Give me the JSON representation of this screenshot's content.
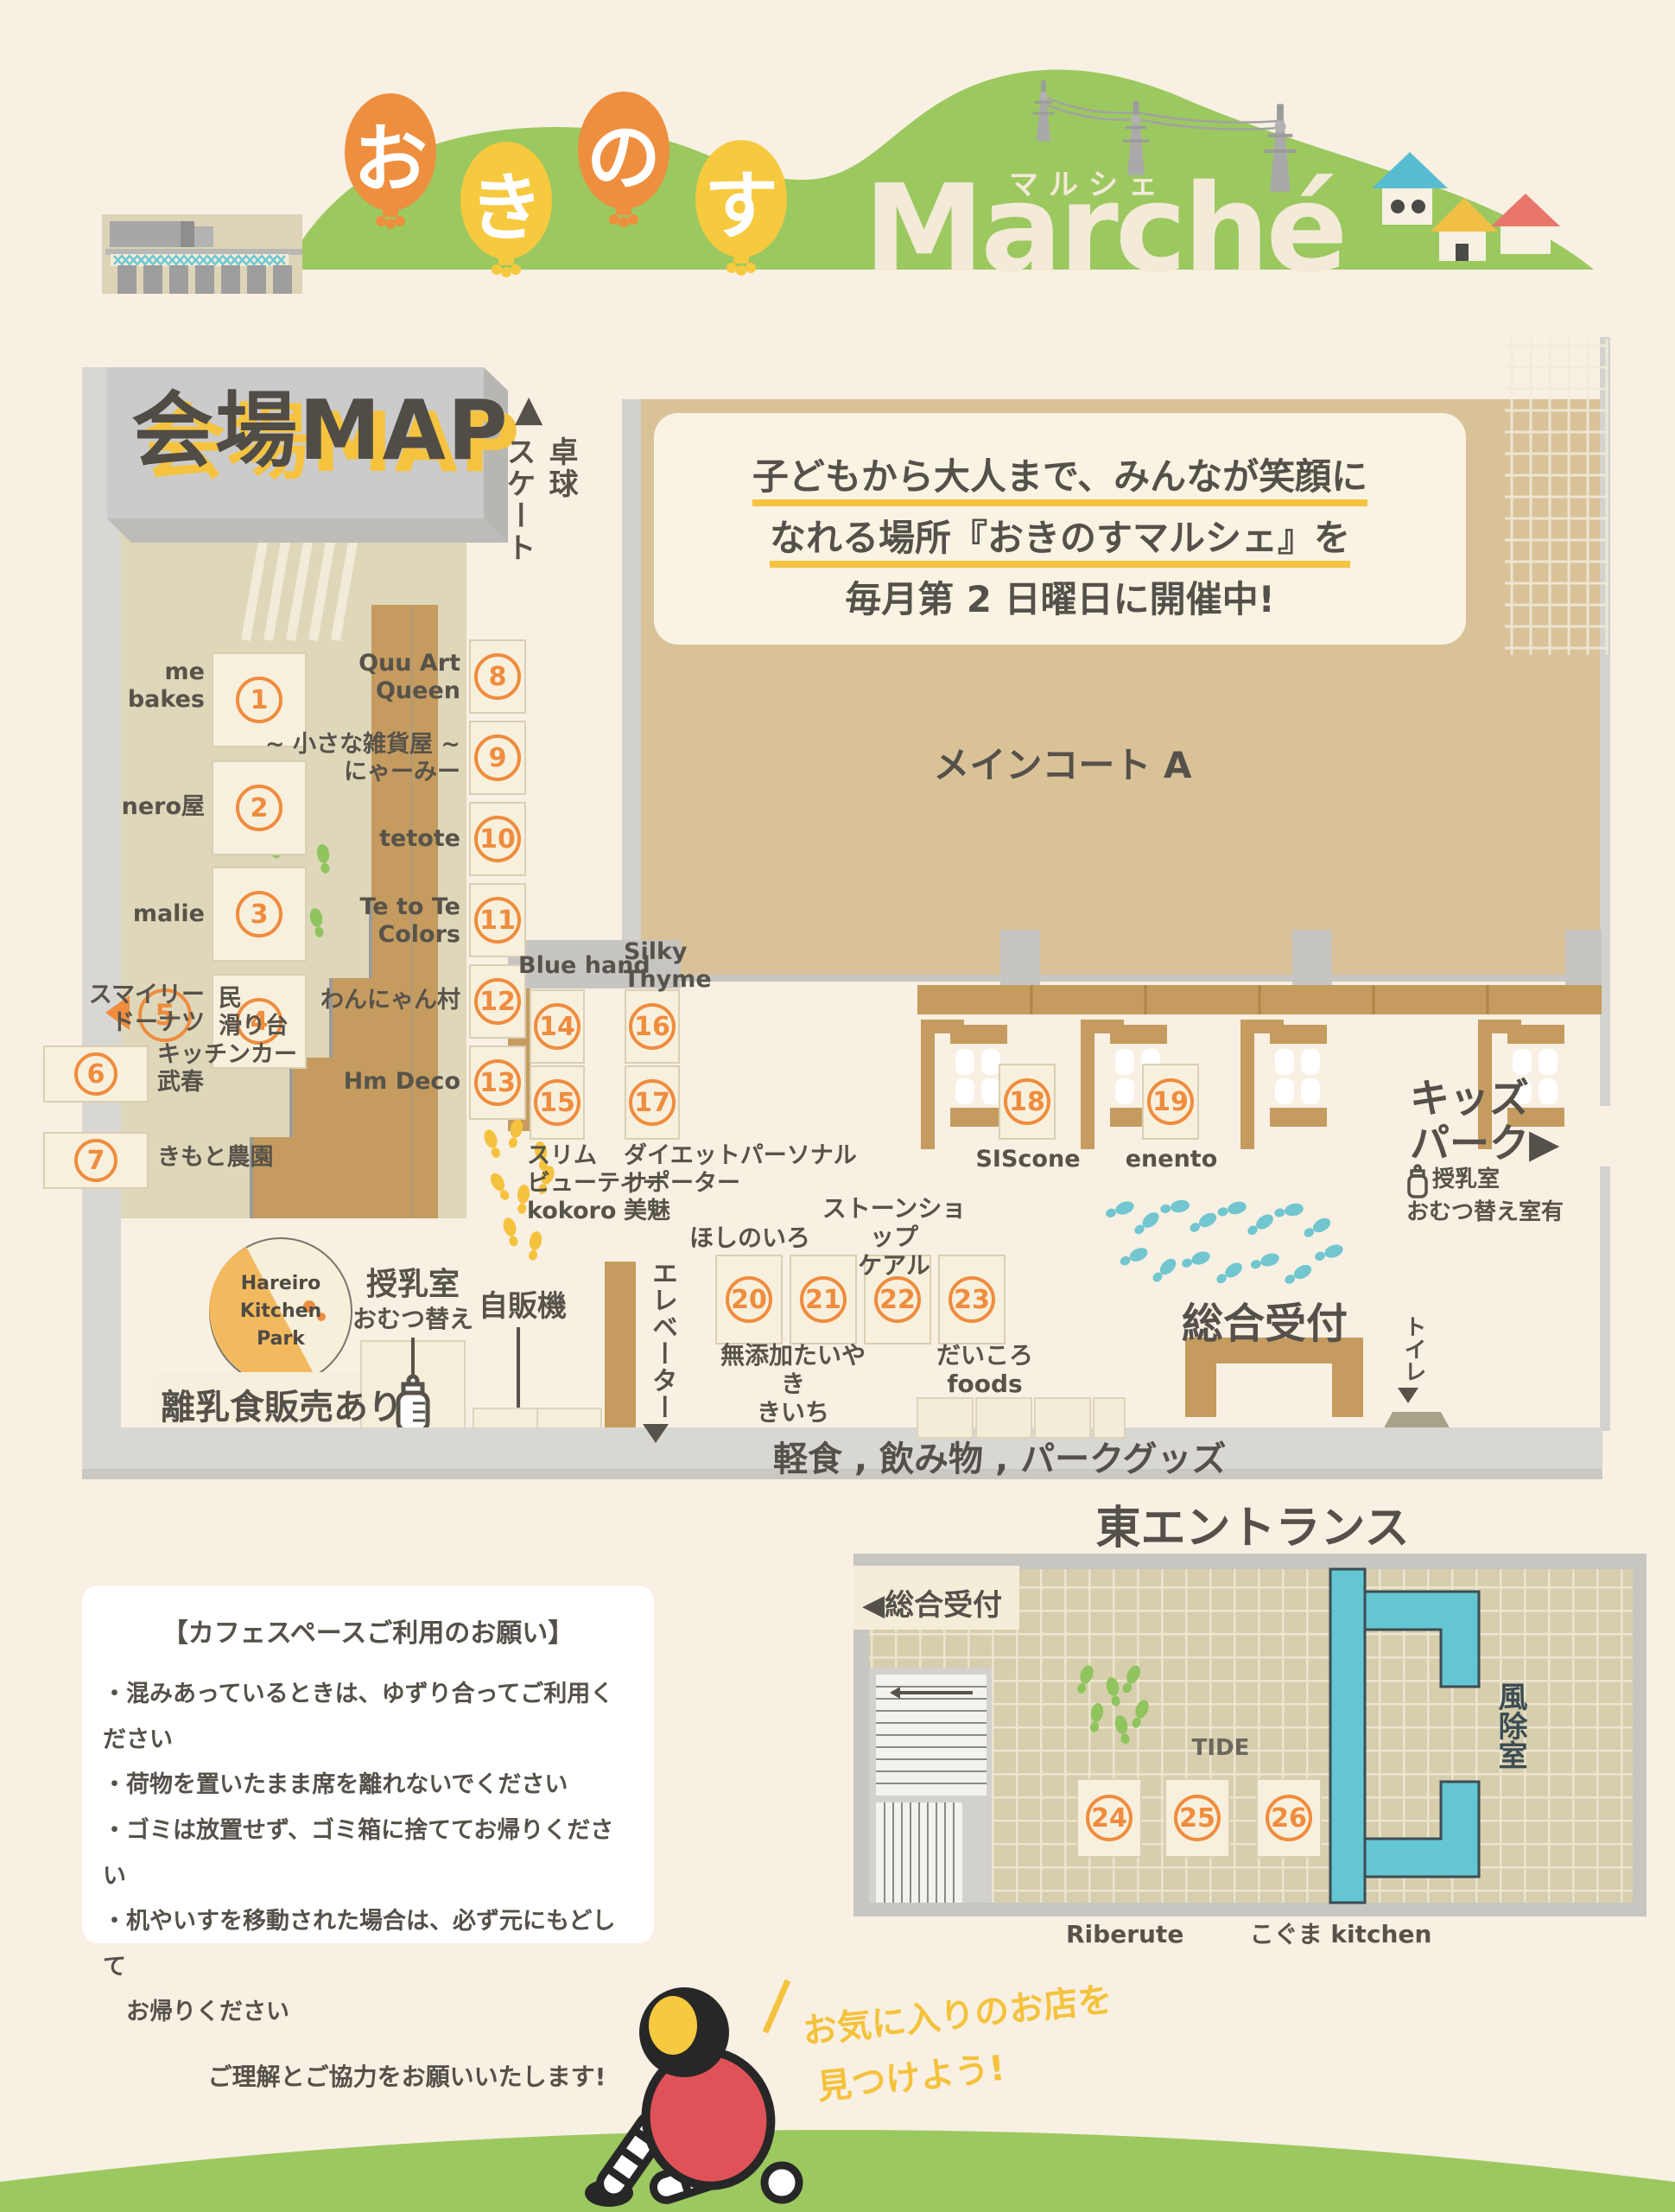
{
  "colors": {
    "accent_orange": "#ee8f3f",
    "accent_yellow": "#f5c33f",
    "green": "#9cc860",
    "teal": "#64c6d2",
    "brown": "#c59b5f",
    "cream_text": "#f3ead7",
    "court_tan": "#d9c298"
  },
  "header": {
    "balloons": [
      "お",
      "き",
      "の",
      "す"
    ],
    "brand": "Marché",
    "brand_kana": "マルシェ"
  },
  "map": {
    "title": "会場MAP",
    "skate_arrow": "▲",
    "skate": "卓球\nスケート",
    "info": {
      "line1": "子どもから大人まで、みんなが笑顔に",
      "line2": "なれる場所『おきのすマルシェ』を",
      "line3": "毎月第 2 日曜日に開催中!"
    },
    "main_court": "メインコート A",
    "walkway": "軽食 , 飲み物 , パークグッズ",
    "kids_park": "キッズ\nパーク▶",
    "kids_note1": "授乳室",
    "kids_note2": "おむつ替え室有",
    "nursing1": "授乳室",
    "nursing2": "おむつ替え",
    "vending": "自販機",
    "elevator": "エレベーター",
    "reception": "総合受付",
    "toilet": "トイレ",
    "baby_food": "離乳食販売あり",
    "hareiro": "Hareiro\nKitchen\nPark"
  },
  "booths": [
    {
      "no": "1",
      "name": "me\nbakes"
    },
    {
      "no": "2",
      "name": "nero屋"
    },
    {
      "no": "3",
      "name": "malie"
    },
    {
      "no": "4",
      "name": "スマイリー\nドーナツ"
    },
    {
      "no": "5",
      "name": "民\n滑り台"
    },
    {
      "no": "6",
      "name": "キッチンカー\n武春"
    },
    {
      "no": "7",
      "name": "きもと農園"
    },
    {
      "no": "8",
      "name": "Quu Art\nQueen"
    },
    {
      "no": "9",
      "name": "~ 小さな雑貨屋 ~\nにゃーみー"
    },
    {
      "no": "10",
      "name": "tetote"
    },
    {
      "no": "11",
      "name": "Te to Te\nColors"
    },
    {
      "no": "12",
      "name": "わんにゃん村"
    },
    {
      "no": "13",
      "name": "Hm Deco"
    },
    {
      "no": "14",
      "name": "Blue hand"
    },
    {
      "no": "15",
      "name": "スリム\nビューティー\nkokoro"
    },
    {
      "no": "16",
      "name": "Silky\nThyme"
    },
    {
      "no": "17",
      "name": "ダイエットパーソナル\nサポーター\n美魅"
    },
    {
      "no": "18",
      "name": "SIScone"
    },
    {
      "no": "19",
      "name": "enento"
    },
    {
      "no": "20",
      "name": "ほしのいろ"
    },
    {
      "no": "21",
      "name": "無添加たいやき\nきいち"
    },
    {
      "no": "22",
      "name": "ストーンショップ\nケアル"
    },
    {
      "no": "23",
      "name": "だいころ foods"
    },
    {
      "no": "24",
      "name": "Riberute"
    },
    {
      "no": "25",
      "name": "TIDE"
    },
    {
      "no": "26",
      "name": "こぐま kitchen"
    }
  ],
  "east": {
    "title": "東エントランス",
    "reception_tab": "◀総合受付",
    "windbreak": "風除室"
  },
  "notice": {
    "title": "【カフェスペースご利用のお願い】",
    "items": [
      "・混みあっているときは、ゆずり合ってご利用ください",
      "・荷物を置いたまま席を離れないでください",
      "・ゴミは放置せず、ゴミ箱に捨ててお帰りください",
      "・机やいすを移動された場合は、必ず元にもどして",
      "　お帰りください"
    ],
    "footer": "ご理解とご協力をお願いいたします!"
  },
  "mascot": {
    "line1": "お気に入りのお店を",
    "line2": "見つけよう!"
  }
}
